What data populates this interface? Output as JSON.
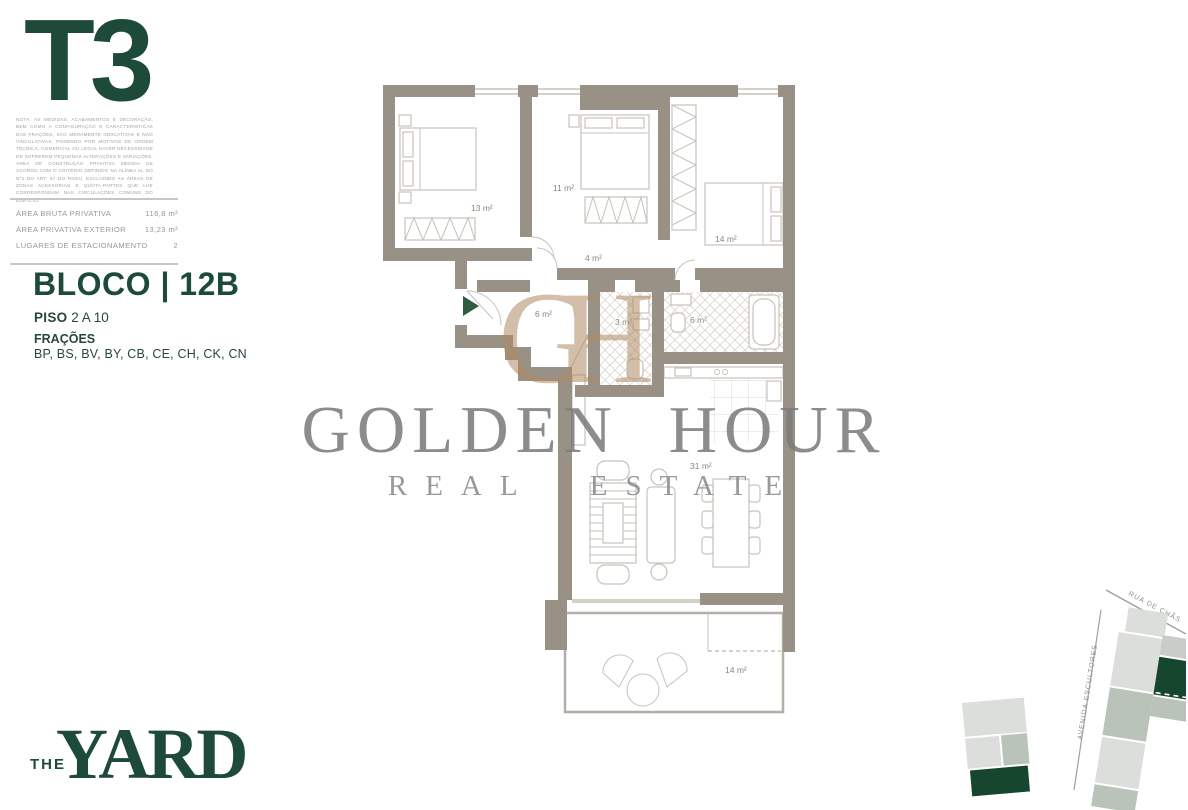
{
  "panel": {
    "typology": "T3",
    "disclaimer": "NOTA: AS MEDIDAS, ACABAMENTOS E DECORAÇÃO, BEM COMO A CONFIGURAÇÃO E CARACTERÍSTICAS DAS FRAÇÕES, SÃO MERAMENTE INDICATIVAS E NÃO VINCULATIVAS, PODENDO POR MOTIVOS DE ORDEM TÉCNICA, COMERCIAL OU LEGAL HAVER NECESSIDADE DE SOFREREM PEQUENAS ALTERAÇÕES E VARIAÇÕES. ÁREA DE CONSTRUÇÃO PRIVATIVA MEDIDA DE ACORDO COM O CRITÉRIO DEFINIDO NA ALÍNEA AL DO Nº2 DO ART. 67 DO RGEU, EXCLUINDO AS ÁREAS DE ZONAS ACESSÓRIAS E QUOTA-PARTES QUE LHE CORRESPONDAM NAS CIRCULAÇÕES COMUNS DO EDIFÍCIO.",
    "specs": [
      {
        "label": "ÁREA BRUTA PRIVATIVA",
        "value": "116,8 m²"
      },
      {
        "label": "ÁREA PRIVATIVA EXTERIOR",
        "value": "13,23 m²"
      },
      {
        "label": "LUGARES DE ESTACIONAMENTO",
        "value": "2"
      }
    ],
    "bloco": "BLOCO | 12B",
    "piso_label": "PISO",
    "piso_value": "2 A 10",
    "fracoes_label": "FRAÇÕES",
    "fracoes_value": "BP, BS, BV, BY, CB, CE, CH, CK, CN"
  },
  "watermark": {
    "monogram": "GH",
    "title": "GOLDEN HOUR",
    "subtitle": "REAL ESTATE"
  },
  "floorplan": {
    "rooms": [
      {
        "name": "bedroom-1",
        "area": "13 m²"
      },
      {
        "name": "bedroom-2",
        "area": "11 m²"
      },
      {
        "name": "bedroom-3",
        "area": "14 m²"
      },
      {
        "name": "hall",
        "area": "4 m²"
      },
      {
        "name": "entrance-hall",
        "area": "6 m²"
      },
      {
        "name": "bathroom-1",
        "area": "3 m²"
      },
      {
        "name": "bathroom-2",
        "area": "6 m²"
      },
      {
        "name": "living-kitchen",
        "area": "31 m²"
      },
      {
        "name": "balcony",
        "area": "14 m²"
      }
    ],
    "entrance_arrow_color": "#2e5c3e",
    "wall_color": "#9a9186"
  },
  "site_map": {
    "street1": "RUA DE CHÃS",
    "street2": "AVENIDA ESCULTORES",
    "highlight_color": "#17462e"
  },
  "logo": {
    "the": "THE",
    "yard": "YARD"
  },
  "colors": {
    "brand_green": "#1d4a39",
    "watermark_gray": "#7d7d7d",
    "monogram_tan": "#b08a63"
  }
}
